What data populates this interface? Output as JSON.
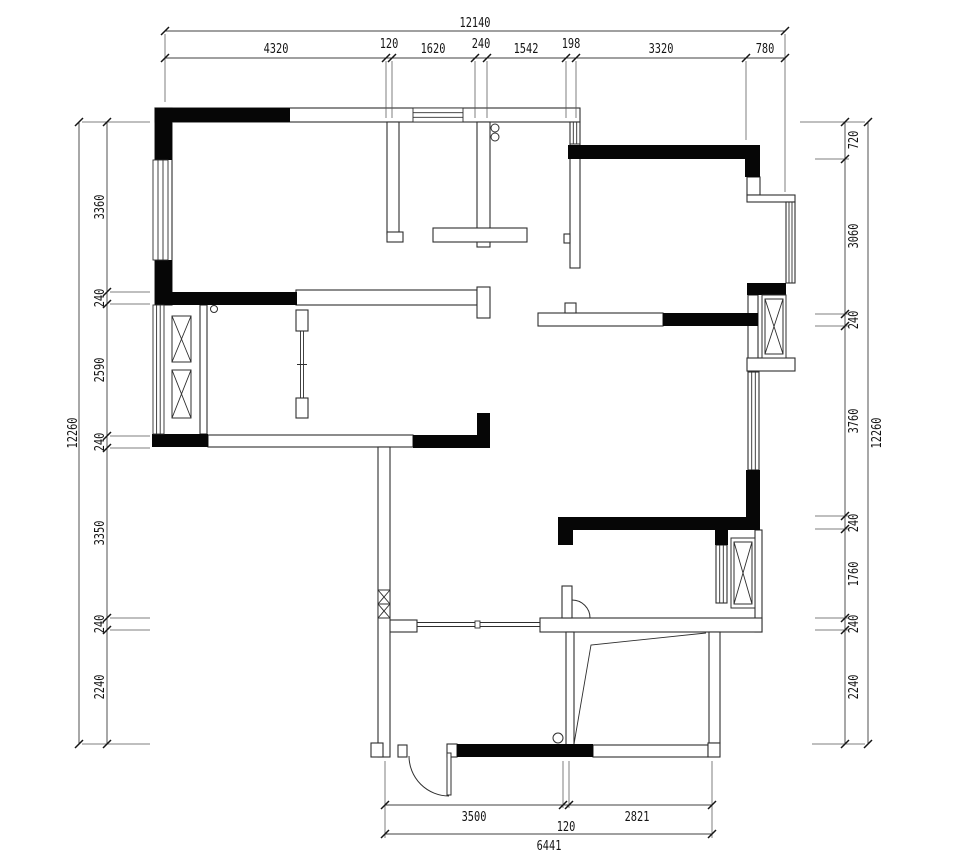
{
  "drawing": {
    "type": "architectural-floor-plan",
    "colors": {
      "background": "#ffffff",
      "wall_solid_fill": "#060606",
      "wall_outline": "#2f2f2f",
      "dimension_line": "#404040",
      "text": "#141414"
    },
    "dimensions": {
      "top": {
        "overall": "12140",
        "segments": [
          "4320",
          "120",
          "1620",
          "240",
          "1542",
          "198",
          "3320",
          "780"
        ]
      },
      "bottom": {
        "overall": "6441",
        "segments": [
          "3500",
          "120",
          "2821"
        ]
      },
      "left": {
        "overall": "12260",
        "segments": [
          "3360",
          "240",
          "2590",
          "240",
          "3350",
          "240",
          "2240"
        ]
      },
      "right": {
        "overall": "12260",
        "segments": [
          "720",
          "3060",
          "240",
          "3760",
          "240",
          "1760",
          "240",
          "2240"
        ]
      }
    },
    "symbols": {
      "window": "parallel-line-glazing",
      "shaft": "x-hatched-box",
      "door": "quarter-arc-swing",
      "sliding_door": "double-line-track"
    }
  }
}
